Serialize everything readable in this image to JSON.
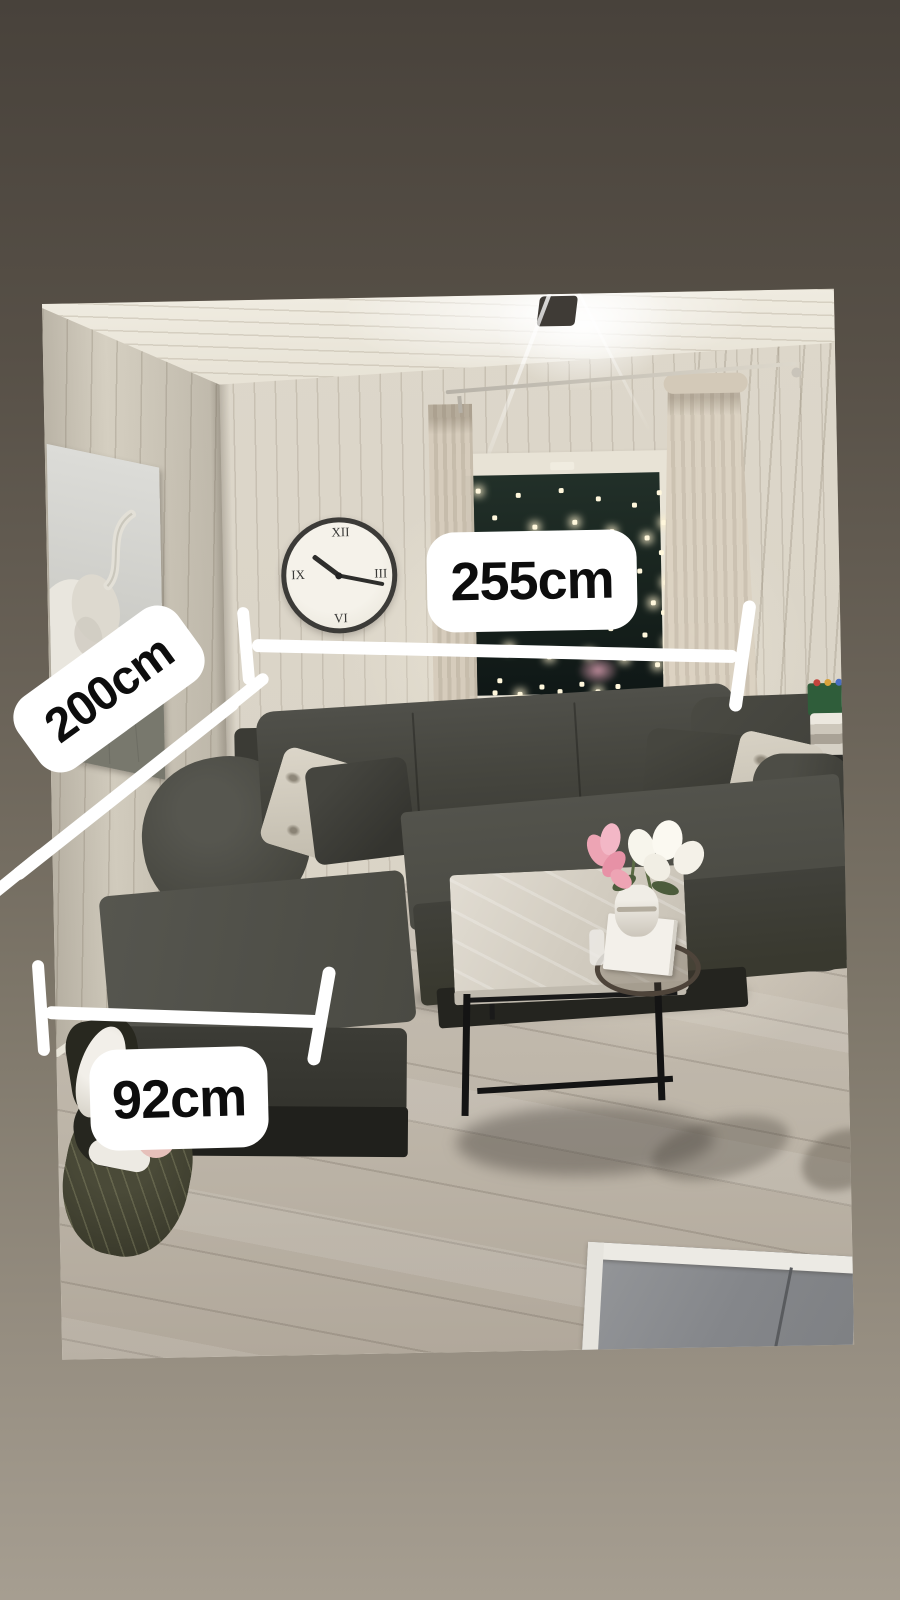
{
  "annotations": {
    "measurements": [
      {
        "id": "sofa-back-width",
        "label": "255cm"
      },
      {
        "id": "sofa-left-depth",
        "label": "200cm"
      },
      {
        "id": "chaise-width",
        "label": "92cm"
      }
    ],
    "line_color": "#ffffff",
    "label_background": "#ffffff",
    "label_text_color": "#0d0d0d"
  },
  "background": {
    "top_color": "#48423b",
    "bottom_color": "#a69e91"
  }
}
